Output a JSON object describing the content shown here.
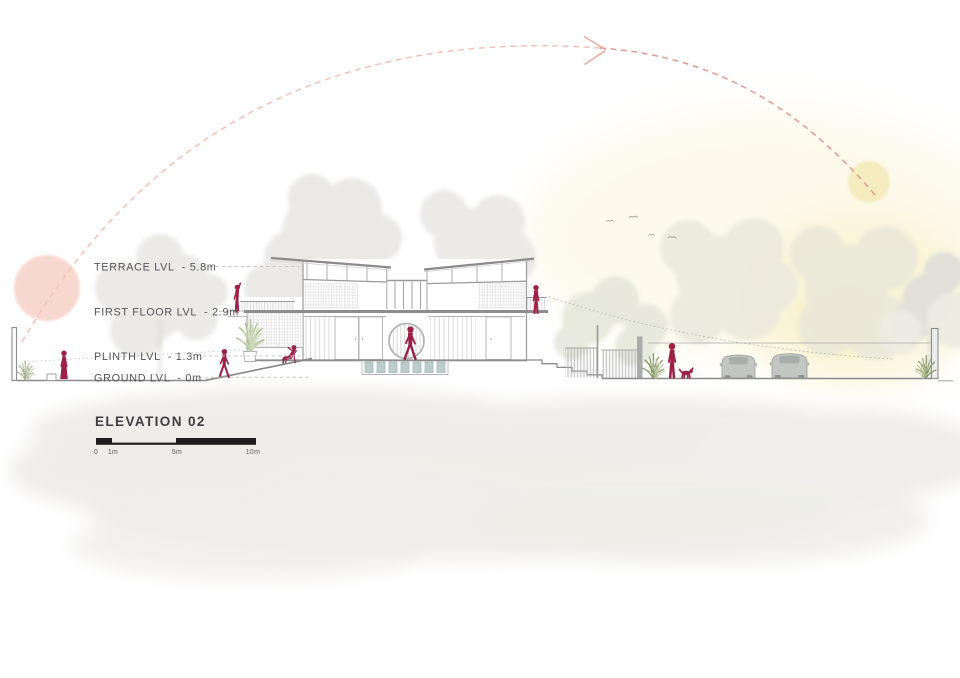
{
  "drawing": {
    "title": "ELEVATION 02",
    "levels": [
      {
        "id": "terrace",
        "label": "TERRACE LVL  - 5.8m"
      },
      {
        "id": "first-floor",
        "label": "FIRST FLOOR LVL  - 2.9m"
      },
      {
        "id": "plinth",
        "label": "PLINTH LVL  - 1.3m"
      },
      {
        "id": "ground",
        "label": "GROUND LVL  - 0m"
      }
    ],
    "scale_bar": {
      "ticks": [
        "0",
        "1m",
        "5m",
        "10m"
      ]
    },
    "colors": {
      "figure_maroon": "#9b2246",
      "sun_path_pink": "#e8a79b",
      "sun_disc_west_pink": "#f7d5cb",
      "sun_disc_east_yellow": "#f4ebbd",
      "sky_glow_yellow": "#f8efc6",
      "foliage_gray": "#e9e8e4",
      "shrub_green": "#87986b",
      "stepping_stone_teal": "#bccccc",
      "car_gray": "#c3c6c3",
      "drawing_line_gray": "#8c8c8c",
      "label_text_gray": "#54545a",
      "scale_bar_black": "#1d1d1d"
    },
    "scene_icons": [
      "sun-path-arrow-icon",
      "sun-disc-icon",
      "bird-icon",
      "person-figure",
      "dog-figure",
      "car-icon",
      "tree-icon",
      "shrub-icon",
      "moon-gate",
      "stepping-stones",
      "scale-bar"
    ]
  }
}
